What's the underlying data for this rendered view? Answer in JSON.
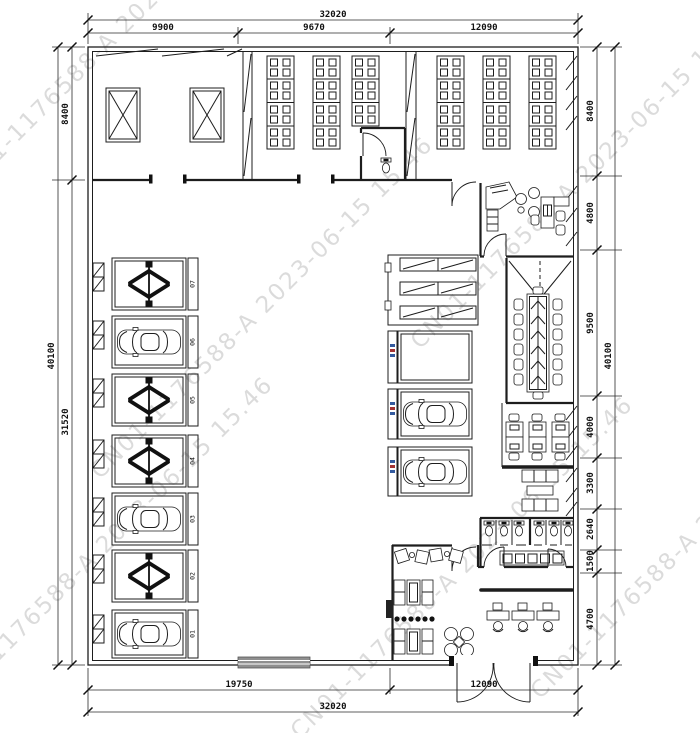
{
  "watermark": {
    "text": "CN01-1176588-A 2023-06-15 15.46",
    "color": "#c6c6c6"
  },
  "dimensions": {
    "top_overall": "32020",
    "top_segments": [
      "9900",
      "9670",
      "12090"
    ],
    "bottom_segments": [
      "19750",
      "12090"
    ],
    "bottom_overall": "32020",
    "left_segments": [
      "8400",
      "31520"
    ],
    "left_overall": "40100",
    "right_segments": [
      "8400",
      "4800",
      "9500",
      "4000",
      "3300",
      "2640",
      "1500",
      "4700"
    ],
    "right_overall": "40100"
  },
  "bays": [
    "07",
    "06",
    "05",
    "04",
    "03",
    "02",
    "01"
  ]
}
